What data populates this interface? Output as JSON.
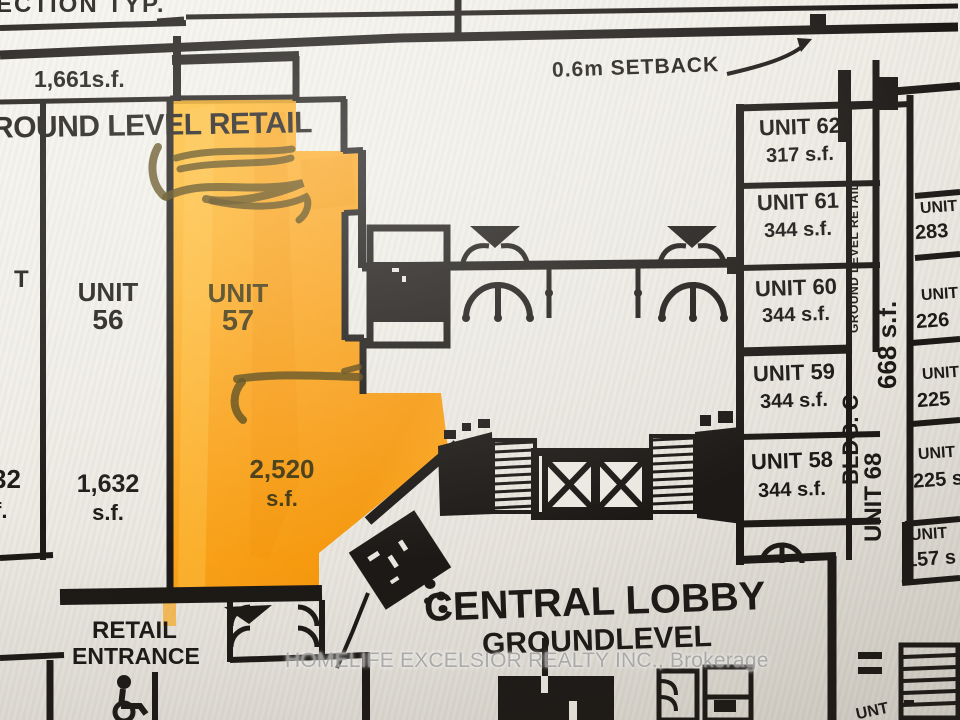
{
  "annotations": {
    "section": "ECTION TYP.",
    "setback": "0.6m SETBACK"
  },
  "areas": {
    "top_left": "1,661s.f."
  },
  "zones": {
    "ground_level_retail": "ROUND LEVEL RETAIL",
    "central_lobby": "CENTRAL LOBBY",
    "ground_level": "GROUNDLEVEL",
    "retail_line1": "RETAIL",
    "retail_line2": "ENTRANCE"
  },
  "unit56": {
    "label": "UNIT",
    "number": "56",
    "area": "1,632",
    "unit": "s.f."
  },
  "highlight_unit": {
    "label": "UNIT",
    "number": "57",
    "area": "2,520",
    "unit": "s.f."
  },
  "left_partial": {
    "unit": "T",
    "area": "32",
    "sf": "f."
  },
  "right_units": [
    {
      "name": "UNIT 62",
      "area": "317 s.f."
    },
    {
      "name": "UNIT 61",
      "area": "344 s.f."
    },
    {
      "name": "UNIT 60",
      "area": "344 s.f."
    },
    {
      "name": "UNIT 59",
      "area": "344 s.f."
    },
    {
      "name": "UNIT 58",
      "area": "344 s.f."
    }
  ],
  "far_right_units": [
    {
      "name": "UNIT",
      "area": "283"
    },
    {
      "name": "UNIT",
      "area": "226"
    },
    {
      "name": "UNIT",
      "area": "225"
    },
    {
      "name": "UNIT",
      "area": "225 s"
    },
    {
      "name": "UNIT",
      "area": "157 s"
    }
  ],
  "vertical_labels": {
    "retail_small": "GROUND LEVEL RETAIL",
    "area_668": "668 s.f.",
    "bldg": "BLDG. C",
    "unit_68": "UNIT 68"
  },
  "bottom_partial": "UNT",
  "photo": {
    "watermark": "HOMELIFE EXCELSIOR REALTY INC., Brokerage"
  },
  "colors": {
    "highlight": "#faa41d",
    "ink": "#1c1916",
    "paper": "#ebe8e1",
    "marker": "#55430f",
    "watermark": "#a9a9a9"
  }
}
